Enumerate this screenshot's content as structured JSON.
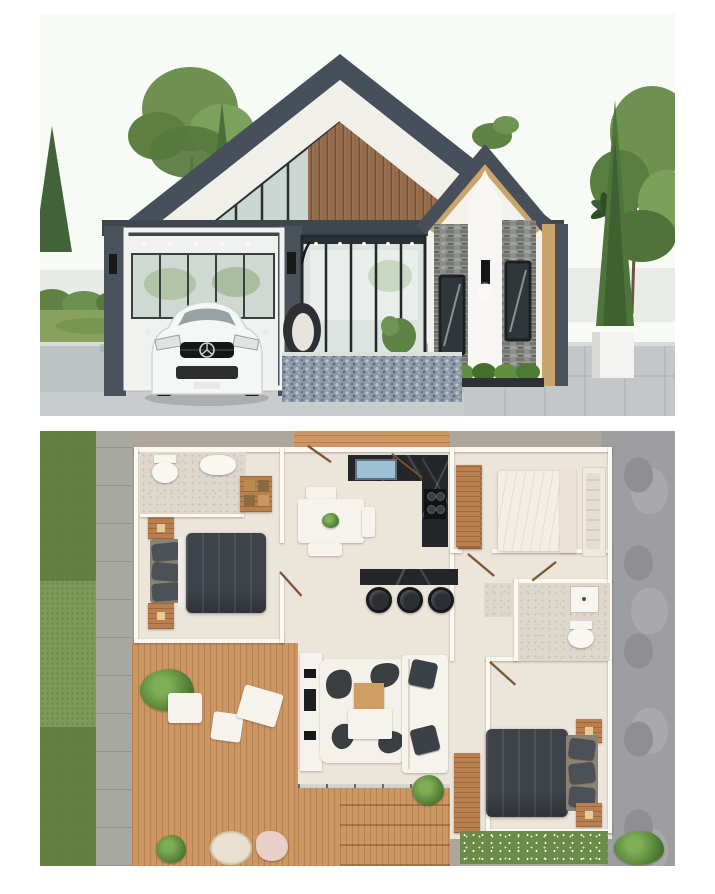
{
  "meta": {
    "artifact": "architectural presentation image, two stacked panels on white background",
    "visible_text": "none"
  },
  "exterior": {
    "alt": "3D exterior render of a modern charcoal and wood double-gable house with carport, white Mercedes car, glass porch with hanging egg chair, stone-clad entry gable, pebble walkway, white planter and landscaped garden"
  },
  "floor_plan": {
    "alt": "Top-down 3D floor plan: left bedroom with dark bed and ensuite bathroom, kitchen with black L-counter and breakfast bar, dining table, top-right bedroom with white bed, right bathroom with shower, living room with white sofa and cowhide rug, bottom-right bedroom with dark bed, large wooden deck and side driveway",
    "rooms": [
      "bedroom-left",
      "bathroom-left",
      "kitchen",
      "dining-area",
      "breakfast-bar",
      "bedroom-top-right",
      "bathroom-right",
      "living-room",
      "bedroom-bottom-right",
      "wood-deck",
      "entry-deck",
      "driveway",
      "garden-strip"
    ]
  },
  "colors": {
    "page_bg": "#ffffff",
    "sky": "#f8faf6",
    "roof": "#47505a",
    "charcoal": "#4a535b",
    "fascia": "#f0efe9",
    "wood_slat": "#97704f",
    "trim": "#c9a46c",
    "glass": "#ccd6d2",
    "frame": "#2c3033",
    "wall_white": "#f2f1eb",
    "lawn": "#86a25e",
    "tree": "#6f9150",
    "tree_dark": "#4c6e38",
    "concrete": "#bdc2c4",
    "pebble": "#8f9aa8",
    "car": "#f5f6f6",
    "plan_bg": "#aca69d",
    "floor": "#ece5da",
    "deck": "#cd9764",
    "deck_dark": "#b97f4e",
    "marble": "#ddd7cc",
    "counter": "#24262a",
    "sink": "#9cc0d6",
    "duvet": "#3e434a",
    "linen": "#f3efe7",
    "grass": "#7d9b58",
    "path": "#a8a8a2",
    "driveway": "#9e9ea1",
    "flowerbed": "#6b8c49",
    "wall": "#fbf8f1",
    "door_wood": "#7a5230"
  }
}
